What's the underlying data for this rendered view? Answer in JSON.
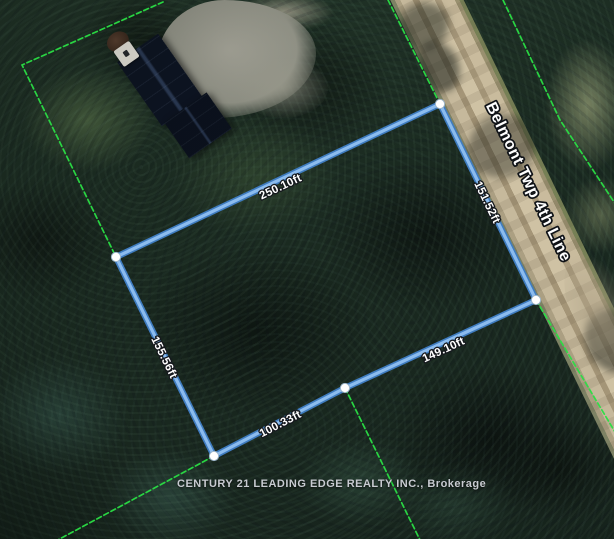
{
  "map": {
    "road": {
      "name": "Belmont Twp 4th Line"
    },
    "attribution": "CENTURY 21 LEADING EDGE REALTY INC., Brokerage"
  },
  "parcel": {
    "sides": [
      {
        "side": "north",
        "label": "250.10ft"
      },
      {
        "side": "east-road-frontage",
        "label": "151.52ft"
      },
      {
        "side": "southeast",
        "label": "149.10ft"
      },
      {
        "side": "south",
        "label": "100.33ft"
      },
      {
        "side": "west",
        "label": "155.56ft"
      }
    ]
  },
  "colors": {
    "lot_line_outer": "#3f7cc0",
    "lot_line_inner": "#8cbcee",
    "boundary_green": "#2ade44",
    "marker_fill": "#ffffff",
    "dimension_text": "#ffffff",
    "dimension_outline": "#15181d",
    "road_name_text": "#ffffff",
    "attribution_text": "#c8cbd1",
    "road_surface": "#c2b498"
  }
}
